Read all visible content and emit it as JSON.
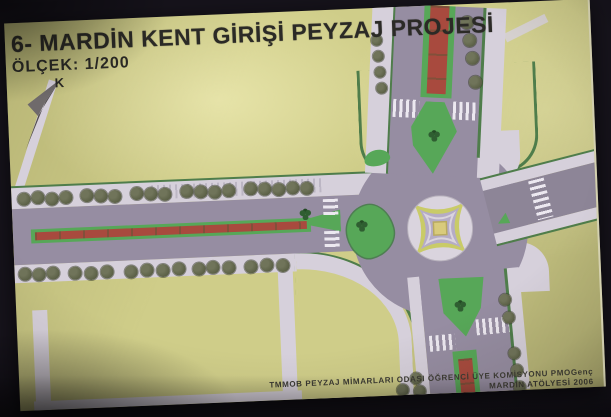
{
  "poster": {
    "title": "6- MARDİN KENT GİRİŞİ PEYZAJ PROJESİ",
    "scale_label": "ÖLÇEK: 1/200",
    "north_label": "K",
    "credits_line1": "TMMOB PEYZAJ MİMARLARI ODASI ÖĞRENCİ ÜYE KOMİSYONU PMOGenç",
    "credits_line2": "MARDİN ATÖLYESİ 2006"
  },
  "colors": {
    "background": "#16131b",
    "paper": "#cfcd89",
    "road": "#968da2",
    "road_dark": "#8d8597",
    "sidewalk": "#d6d0db",
    "stripe": "#ece8f0",
    "island_green": "#57a758",
    "edge_green": "#4f7d4b",
    "median_red": "#a84a3e",
    "tree": "#5c6147",
    "shrub": "#2f5e31",
    "center_ring_yellow": "#c9cb68",
    "center_lavender": "#b5acc6",
    "center_gold": "#d9cb7c",
    "center_pale": "#dad4de",
    "text": "#2b2a26"
  },
  "plan": {
    "tree_groups": [
      {
        "name": "boulevard-top-row-tree",
        "size": 13,
        "points": [
          [
            12,
            176
          ],
          [
            26,
            175
          ],
          [
            40,
            177
          ],
          [
            54,
            176
          ],
          [
            75,
            175
          ],
          [
            89,
            176
          ],
          [
            103,
            177
          ],
          [
            125,
            175
          ],
          [
            139,
            176
          ],
          [
            153,
            177
          ],
          [
            175,
            175
          ],
          [
            189,
            176
          ],
          [
            203,
            177
          ],
          [
            217,
            176
          ],
          [
            239,
            175
          ],
          [
            253,
            176
          ],
          [
            267,
            177
          ],
          [
            281,
            176
          ],
          [
            295,
            177
          ]
        ]
      },
      {
        "name": "boulevard-bottom-row-tree",
        "size": 13,
        "points": [
          [
            10,
            251
          ],
          [
            24,
            252
          ],
          [
            38,
            251
          ],
          [
            60,
            252
          ],
          [
            76,
            253
          ],
          [
            92,
            252
          ],
          [
            116,
            253
          ],
          [
            132,
            252
          ],
          [
            148,
            253
          ],
          [
            164,
            252
          ],
          [
            184,
            253
          ],
          [
            198,
            252
          ],
          [
            214,
            253
          ],
          [
            236,
            253
          ],
          [
            252,
            252
          ],
          [
            268,
            253
          ]
        ]
      },
      {
        "name": "north-road-left-tree",
        "size": 11,
        "points": [
          [
            371,
            32
          ],
          [
            372,
            48
          ],
          [
            373,
            64
          ],
          [
            374,
            80
          ]
        ]
      },
      {
        "name": "north-road-right-tree",
        "size": 13,
        "points": [
          [
            462,
            18
          ],
          [
            464,
            36
          ],
          [
            466,
            54
          ],
          [
            468,
            78
          ]
        ]
      },
      {
        "name": "south-road-left-tree",
        "size": 12,
        "points": [
          [
            397,
            372
          ],
          [
            400,
            385
          ],
          [
            383,
            383
          ]
        ]
      },
      {
        "name": "south-road-right-tree",
        "size": 12,
        "points": [
          [
            489,
            297
          ],
          [
            492,
            315
          ],
          [
            496,
            351
          ],
          [
            498,
            368
          ],
          [
            500,
            385
          ]
        ]
      }
    ],
    "shrubs": [
      [
        293,
        203
      ],
      [
        349,
        217
      ],
      [
        425,
        130
      ],
      [
        444,
        301
      ]
    ]
  }
}
